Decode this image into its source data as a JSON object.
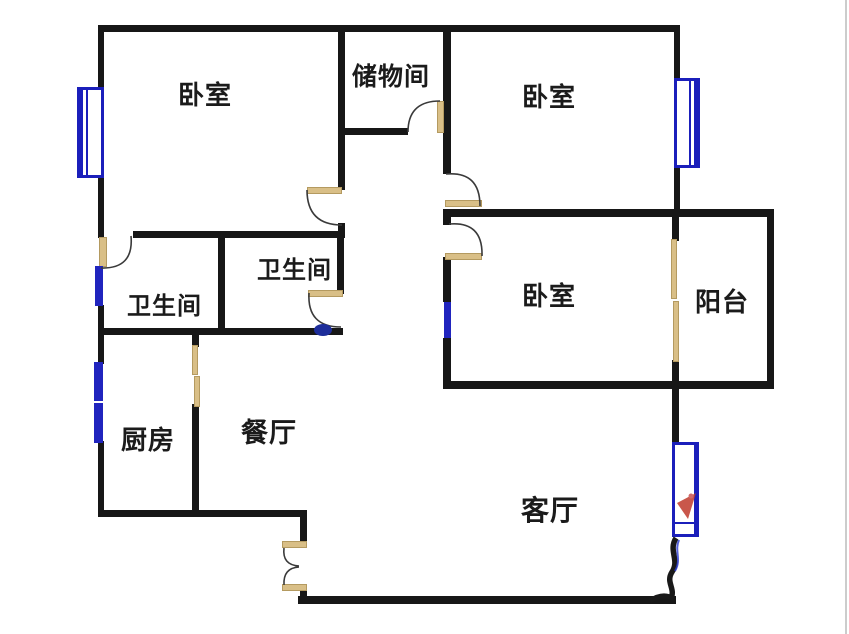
{
  "floorplan": {
    "type": "apartment-floor-plan",
    "rooms": [
      {
        "id": "bedroom_top_left",
        "label": "卧室"
      },
      {
        "id": "storage",
        "label": "储物间"
      },
      {
        "id": "bedroom_top_right",
        "label": "卧室"
      },
      {
        "id": "bathroom_left",
        "label": "卫生间"
      },
      {
        "id": "bathroom_right",
        "label": "卫生间"
      },
      {
        "id": "bedroom_right",
        "label": "卧室"
      },
      {
        "id": "balcony",
        "label": "阳台"
      },
      {
        "id": "kitchen",
        "label": "厨房"
      },
      {
        "id": "dining",
        "label": "餐厅"
      },
      {
        "id": "living",
        "label": "客厅"
      }
    ],
    "colors": {
      "wall": "#171717",
      "door_leaf": "#d9bf87",
      "window_blue": "#1b1fbb",
      "artifact_red": "#c0392b",
      "background": "#ffffff"
    }
  }
}
